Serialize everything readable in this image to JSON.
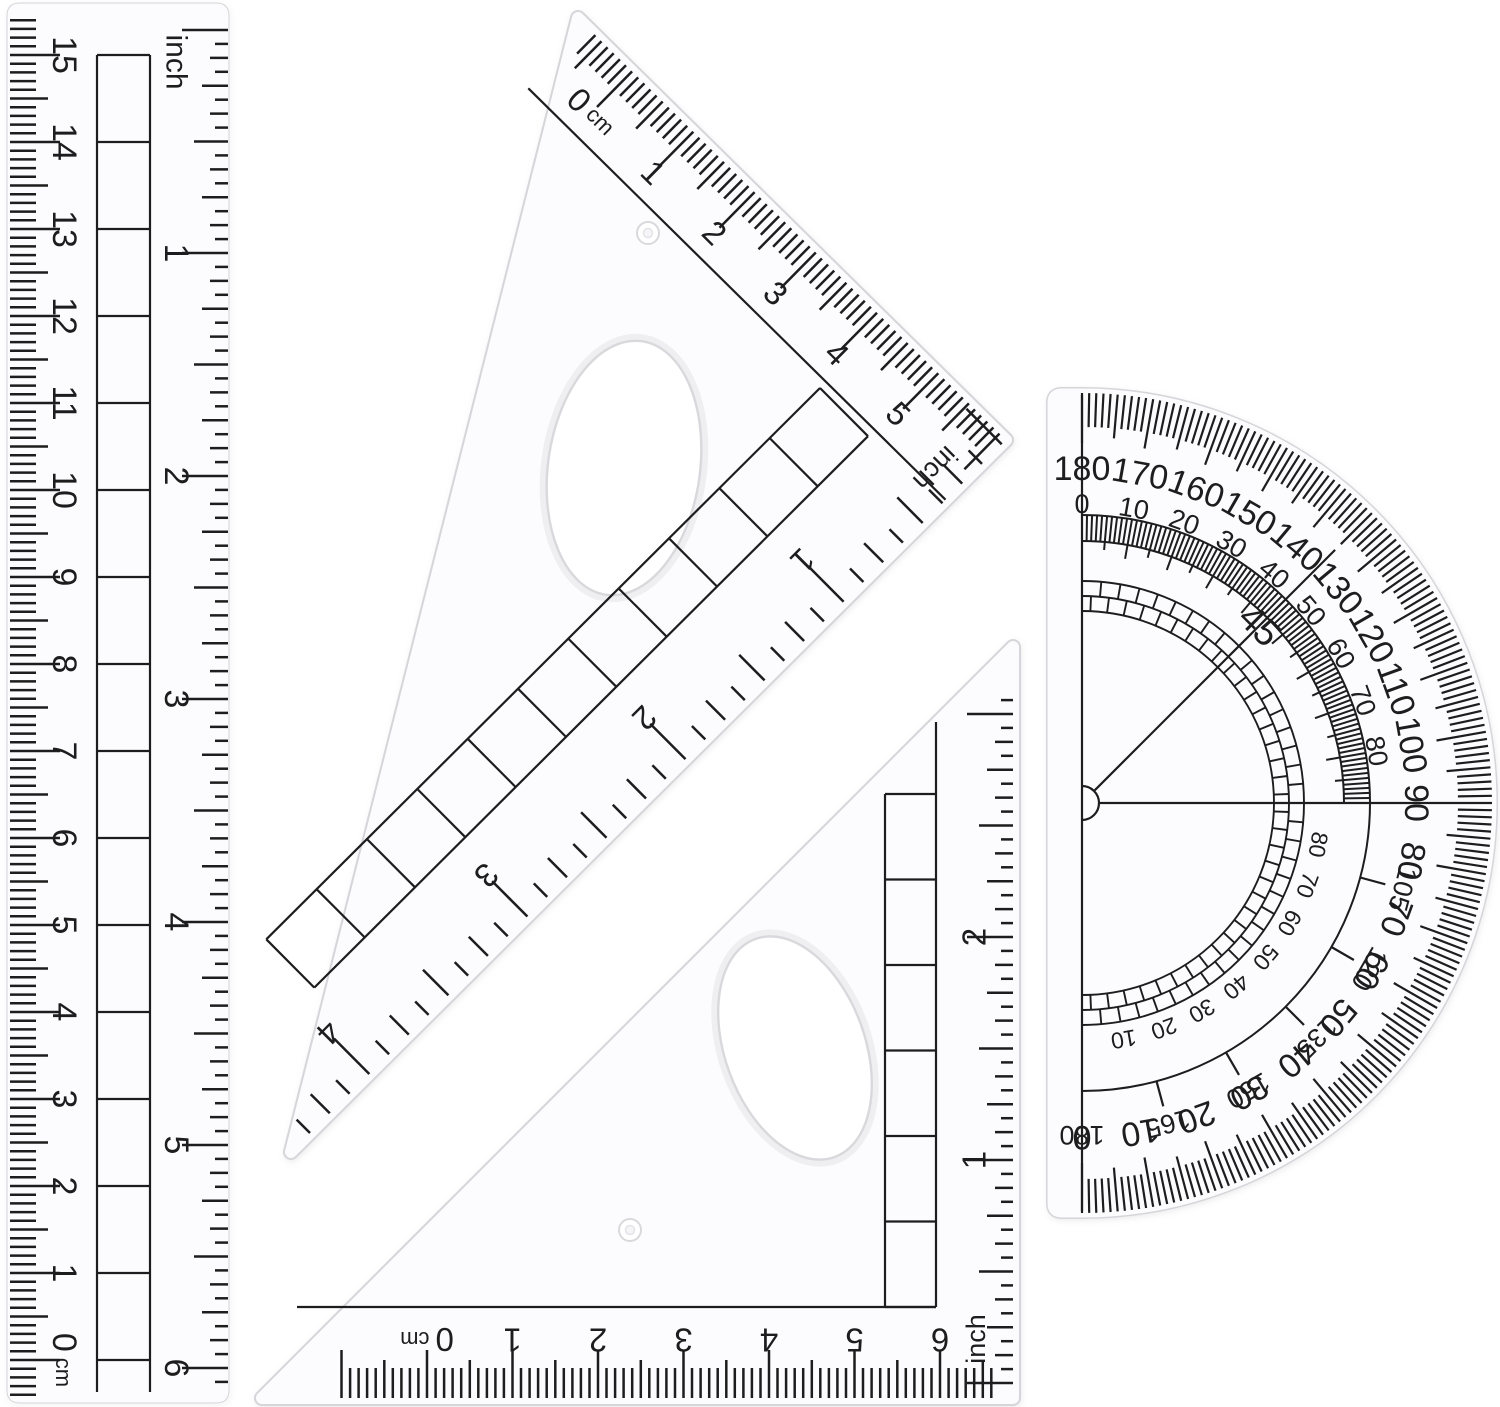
{
  "colors": {
    "background": "#ffffff",
    "ink": "#1d1d1d",
    "plastic_fill": "#fcfcfe",
    "plastic_edge": "#d5d5da",
    "cutout_edge": "#d9d9dd"
  },
  "ruler": {
    "cm_scale": {
      "zero_label": "0 cm",
      "numbers": [
        "1",
        "2",
        "3",
        "4",
        "5",
        "6",
        "7",
        "8",
        "9",
        "10",
        "11",
        "12",
        "13",
        "14",
        "15"
      ]
    },
    "inch_scale": {
      "unit_label": "inch",
      "numbers": [
        "1",
        "2",
        "3",
        "4",
        "5",
        "6"
      ]
    }
  },
  "triangle_large": {
    "cm_scale": {
      "zero_label": "0 cm",
      "numbers": [
        "1",
        "2",
        "3",
        "4",
        "5"
      ]
    },
    "inch_scale": {
      "unit_label": "inch",
      "numbers": [
        "1",
        "2",
        "3",
        "4"
      ]
    }
  },
  "triangle_small": {
    "cm_scale": {
      "zero_label": "0 cm",
      "numbers": [
        "1",
        "2",
        "3",
        "4",
        "5",
        "6"
      ]
    },
    "inch_scale": {
      "unit_label": "inch",
      "numbers": [
        "1",
        "2"
      ]
    }
  },
  "protractor": {
    "outer_scale": {
      "numbers": [
        180,
        170,
        160,
        150,
        140,
        130,
        120,
        110,
        100,
        90,
        80,
        70,
        60,
        50,
        40,
        30,
        20,
        10,
        0
      ]
    },
    "inner_scale_upper": {
      "numbers": [
        0,
        10,
        20,
        30,
        40,
        50,
        60,
        70,
        80
      ]
    },
    "inner_scale_lower": {
      "numbers": [
        105,
        120,
        135,
        150,
        165,
        180
      ]
    },
    "band_scale_lower": {
      "numbers": [
        80,
        70,
        60,
        50,
        40,
        30,
        20,
        10
      ]
    },
    "diagonal_label": "45"
  }
}
